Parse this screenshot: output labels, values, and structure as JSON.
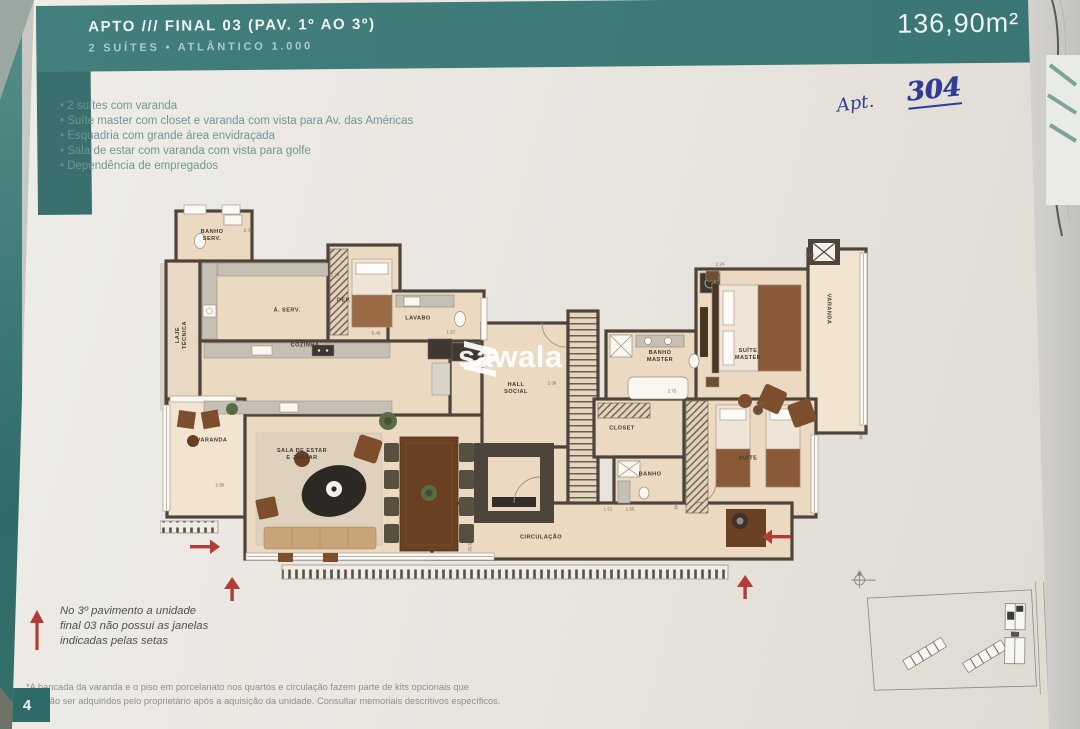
{
  "header": {
    "title": "APTO /// FINAL 03 (PAV. 1º AO 3º)",
    "subtitle": "2 SUÍTES • ATLÂNTICO 1.000",
    "area": "136,90m²"
  },
  "annotation": {
    "prefix": "Apt.",
    "number": "304"
  },
  "features": [
    "2 suítes com varanda",
    "Suíte master com closet e varanda com vista para Av. das Américas",
    "Esquadria com grande área envidraçada",
    "Sala de estar com varanda com vista para golfe",
    "Dependência de empregados"
  ],
  "watermark": {
    "text": "sawala"
  },
  "colors": {
    "teal": "#3a7674",
    "wall": "#4d443c",
    "floor": "#ecd9c2",
    "arrow_red": "#b23b35",
    "pen_blue": "#2f3e94"
  },
  "plan": {
    "rooms": [
      {
        "label": "BANHO\nSERV.",
        "x": 52,
        "y": 33,
        "rot": 0
      },
      {
        "label": "LAJE\nTÉCNICA",
        "x": 22,
        "y": 132,
        "rot": -90
      },
      {
        "label": "Á. SERV.",
        "x": 127,
        "y": 108,
        "rot": 0
      },
      {
        "label": "DEP.",
        "x": 184,
        "y": 98,
        "rot": 0
      },
      {
        "label": "COZINHA",
        "x": 145,
        "y": 143,
        "rot": 0
      },
      {
        "label": "LAVABO",
        "x": 258,
        "y": 116,
        "rot": 0
      },
      {
        "label": "HALL\nSOCIAL",
        "x": 356,
        "y": 186,
        "rot": 0
      },
      {
        "label": "CLOSET",
        "x": 462,
        "y": 226,
        "rot": 0
      },
      {
        "label": "BANHO\nMASTER",
        "x": 500,
        "y": 154,
        "rot": 0
      },
      {
        "label": "SUÍTE\nMASTER",
        "x": 588,
        "y": 152,
        "rot": 0
      },
      {
        "label": "VARANDA",
        "x": 668,
        "y": 106,
        "rot": 90
      },
      {
        "label": "BANHO",
        "x": 490,
        "y": 272,
        "rot": 0
      },
      {
        "label": "SUÍTE",
        "x": 588,
        "y": 256,
        "rot": 0
      },
      {
        "label": "VARANDA",
        "x": 52,
        "y": 238,
        "rot": 0
      },
      {
        "label": "SALA DE ESTAR\nE JANTAR",
        "x": 142,
        "y": 252,
        "rot": 0
      },
      {
        "label": "CIRCULAÇÃO",
        "x": 381,
        "y": 335,
        "rot": 0
      }
    ],
    "dimensions": [
      {
        "t": "2.30",
        "x": 88,
        "y": 27,
        "rot": 0
      },
      {
        "t": "2.74",
        "x": 175,
        "y": 72,
        "rot": 0
      },
      {
        "t": "1.75",
        "x": 221,
        "y": 118,
        "rot": 0
      },
      {
        "t": "5.49",
        "x": 216,
        "y": 130,
        "rot": 0
      },
      {
        "t": "1.57",
        "x": 291,
        "y": 129,
        "rot": 0
      },
      {
        "t": "2.36",
        "x": 392,
        "y": 180,
        "rot": 0
      },
      {
        "t": "2.24",
        "x": 560,
        "y": 61,
        "rot": 0
      },
      {
        "t": "2.75",
        "x": 512,
        "y": 188,
        "rot": 0
      },
      {
        "t": "4.24",
        "x": 600,
        "y": 200,
        "rot": 0
      },
      {
        "t": "4.01",
        "x": 650,
        "y": 52,
        "rot": 0
      },
      {
        "t": "1.04",
        "x": 701,
        "y": 232,
        "rot": 90
      },
      {
        "t": "1.55",
        "x": 470,
        "y": 306,
        "rot": 0
      },
      {
        "t": "1.51",
        "x": 448,
        "y": 306,
        "rot": 0
      },
      {
        "t": "2.43",
        "x": 516,
        "y": 302,
        "rot": 90
      },
      {
        "t": "8.52",
        "x": 310,
        "y": 344,
        "rot": 90
      },
      {
        "t": "2.56",
        "x": 60,
        "y": 282,
        "rot": 0
      }
    ]
  },
  "notes": {
    "arrow_note": "No 3º pavimento a unidade\nfinal 03 não possui as janelas\nindicadas pelas setas",
    "footnote": "*A bancada da varanda e o piso em porcelanato nos quartos e circulação fazem parte de kits opcionais que\npoderão ser adquiridos pelo proprietário após a aquisição da unidade. Consultar memoriais descritivos específicos."
  },
  "page_number": "4"
}
